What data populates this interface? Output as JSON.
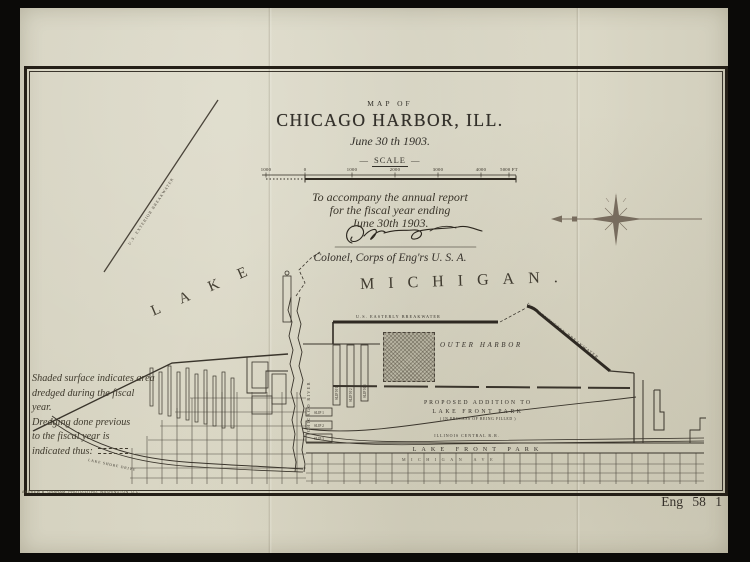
{
  "photo": {
    "plate_number": "Eng 58 1",
    "imprint": "ANDREW B. GRAHAM, PHOTO-LITHO. WASHINGTON, D.C."
  },
  "title_block": {
    "kicker": "MAP OF",
    "title": "CHICAGO HARBOR, ILL.",
    "date": "June 30 th 1903.",
    "scale_dash": "—",
    "scale_label": "SCALE",
    "scale_ticks": [
      "1000",
      "0",
      "1000",
      "2000",
      "3000",
      "4000",
      "5000 FT"
    ]
  },
  "statement": {
    "line1": "To accompany the annual report",
    "line2": "for the fiscal year ending",
    "line3": "June 30th 1903.",
    "signed_title": "Colonel, Corps of Eng'rs U. S. A."
  },
  "water": {
    "lake": "LAKE",
    "michigan": "MICHIGAN."
  },
  "map_labels": {
    "exterior_breakwater": "U.S. EXTERIOR BREAKWATER",
    "easterly_breakwater": "U.S. EASTERLY BREAKWATER",
    "southerly_breakwater": "U.S. SOUTHERLY BREAKWATER",
    "outer_harbor": "OUTER HARBOR",
    "chicago_river": "CHICAGO RIVER",
    "proposed_addition_line1": "PROPOSED ADDITION TO",
    "proposed_addition_line2": "LAKE FRONT PARK",
    "proposed_addition_line3": "( IN PROCESS OF BEING FILLED )",
    "illinois_central_rr": "ILLINOIS CENTRAL R.R.",
    "lake_front_park": "LAKE FRONT PARK",
    "michigan_ave": "MICHIGAN AVE",
    "lake_shore_drive": "LAKE SHORE DRIVE",
    "slips_vertical": [
      "SLIP Nº1",
      "SLIP Nº2",
      "SLIP Nº3"
    ],
    "slips_horizontal": [
      "SLIP 1",
      "SLIP 2",
      "SLIP 3"
    ]
  },
  "legend_note": {
    "lines": [
      "Shaded surface indicates area",
      "dredged during the fiscal",
      "year.",
      "Dredging done previous",
      "to the fiscal year is",
      "indicated thus:"
    ]
  },
  "colors": {
    "paper": "#d8d5c3",
    "ink": "#2f2a21",
    "frame": "#241f17",
    "photo_background": "#0b0a08",
    "compass": "#6e6254"
  }
}
